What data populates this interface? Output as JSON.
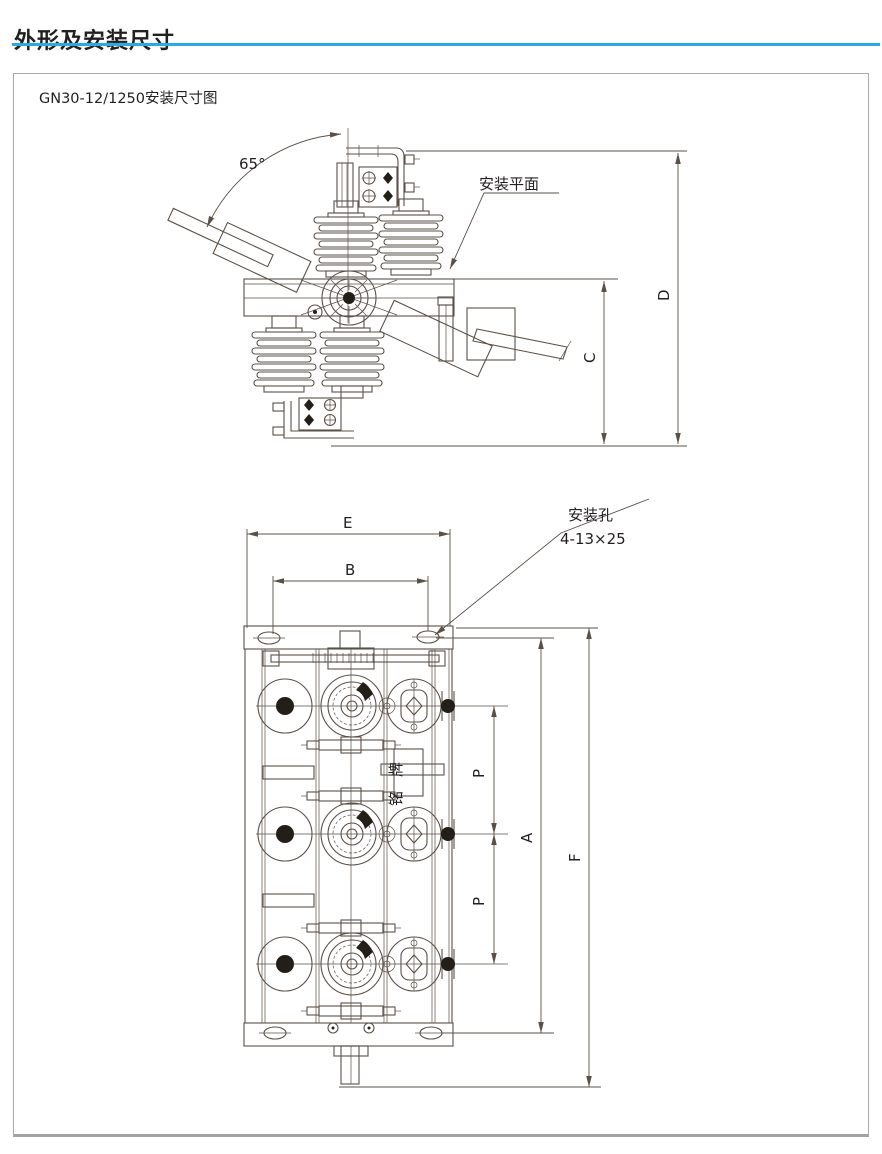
{
  "page": {
    "title": "外形及安装尺寸"
  },
  "figure": {
    "caption": "GN30-12/1250安装尺寸图",
    "side_view": {
      "angle": "65°",
      "mounting_plane_label": "安装平面",
      "dim_c": "C",
      "dim_d": "D"
    },
    "plan_view": {
      "dim_e": "E",
      "dim_b": "B",
      "dim_a": "A",
      "dim_f": "F",
      "dim_p1": "P",
      "dim_p2": "P",
      "mounting_hole_title": "安装孔",
      "mounting_hole_spec": "4-13×25",
      "nameplate": "铭牌"
    }
  },
  "colors": {
    "accent_rule": "#29abe2",
    "drawing_line": "#5a5048",
    "ink": "#231f20"
  }
}
